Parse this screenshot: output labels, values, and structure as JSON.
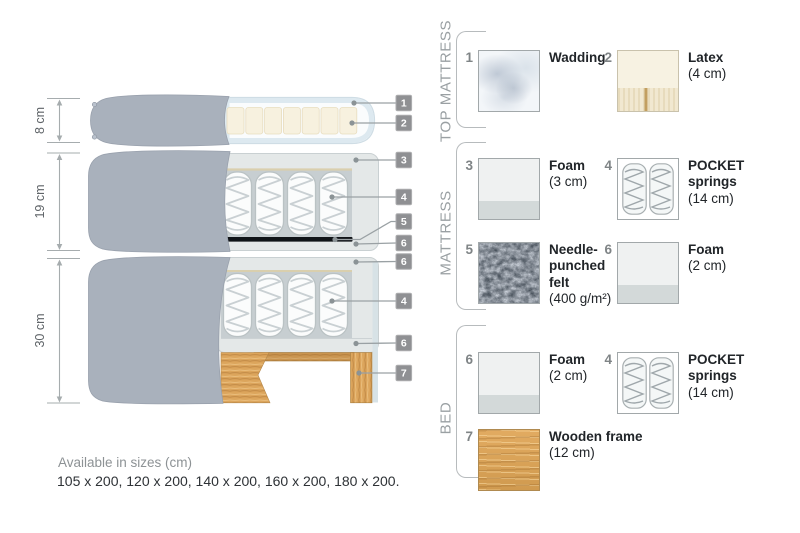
{
  "diagram": {
    "dimension_labels": [
      "8 cm",
      "19 cm",
      "30 cm"
    ],
    "callouts": [
      "1",
      "2",
      "3",
      "4",
      "5",
      "6",
      "6",
      "4",
      "6",
      "7"
    ]
  },
  "legend": {
    "sections": [
      {
        "title": "TOP MATTRESS",
        "items": [
          {
            "number": "1",
            "name": "Wadding",
            "size": ""
          },
          {
            "number": "2",
            "name": "Latex",
            "size": "(4 cm)"
          }
        ]
      },
      {
        "title": "MATTRESS",
        "items": [
          {
            "number": "3",
            "name": "Foam",
            "size": "(3 cm)"
          },
          {
            "number": "4",
            "name": "POCKET springs",
            "size": "(14 cm)"
          },
          {
            "number": "5",
            "name": "Needle-punched felt",
            "size": "(400 g/m²)"
          },
          {
            "number": "6",
            "name": "Foam",
            "size": "(2 cm)"
          }
        ]
      },
      {
        "title": "BED",
        "items": [
          {
            "number": "6",
            "name": "Foam",
            "size": "(2 cm)"
          },
          {
            "number": "4",
            "name": "POCKET springs",
            "size": "(14 cm)"
          },
          {
            "number": "7",
            "name": "Wooden frame",
            "size": "(12 cm)"
          }
        ]
      }
    ]
  },
  "footer": {
    "availability_label": "Available in sizes (cm)",
    "sizes": "105 x 200, 120 x 200, 140 x 200, 160 x 200, 180 x 200."
  },
  "colors": {
    "cover_fabric": "#a9b1bc",
    "wood": "#d9a158",
    "felt": "#4a525c",
    "tag": "#8f9093"
  }
}
